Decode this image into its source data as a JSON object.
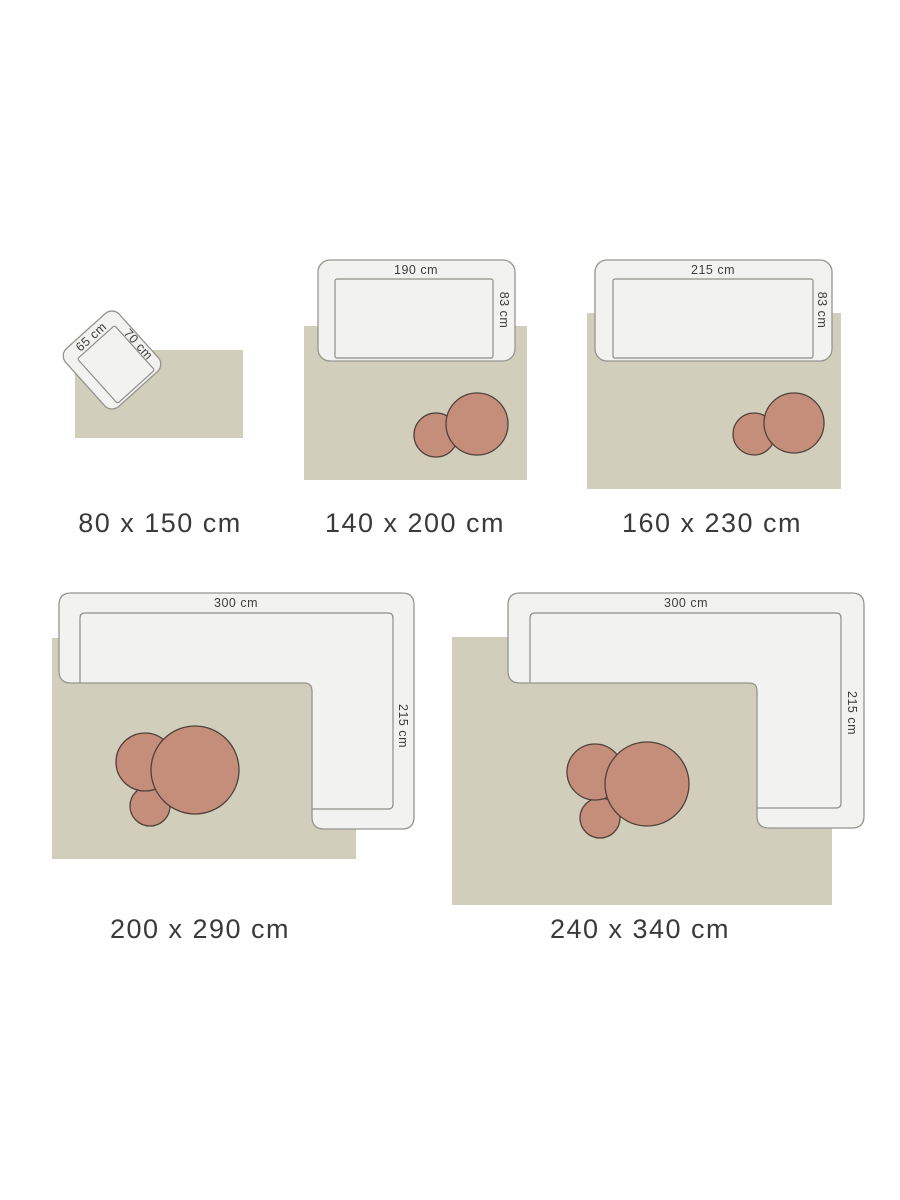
{
  "colors": {
    "rug": "#d1cebc",
    "furniture_fill": "#f2f2f0",
    "furniture_outline": "#95958f",
    "seat_line": "#8e8e88",
    "table_fill": "#c48e7b",
    "table_outline": "#4f423b",
    "dim_text": "#3d3d3d",
    "label_text": "#3a3a3a"
  },
  "panels": [
    {
      "size_label": "80 x 150 cm",
      "furniture": {
        "type": "armchair",
        "width_label": "65 cm",
        "depth_label": "70 cm"
      },
      "tables": 0
    },
    {
      "size_label": "140 x 200 cm",
      "furniture": {
        "type": "sofa",
        "width_label": "190 cm",
        "depth_label": "83 cm"
      },
      "tables": 2
    },
    {
      "size_label": "160 x 230 cm",
      "furniture": {
        "type": "sofa",
        "width_label": "215 cm",
        "depth_label": "83 cm"
      },
      "tables": 2
    },
    {
      "size_label": "200 x 290 cm",
      "furniture": {
        "type": "corner-sofa",
        "width_label": "300 cm",
        "depth_label": "215 cm"
      },
      "tables": 3
    },
    {
      "size_label": "240 x 340 cm",
      "furniture": {
        "type": "corner-sofa",
        "width_label": "300 cm",
        "depth_label": "215 cm"
      },
      "tables": 3
    }
  ]
}
